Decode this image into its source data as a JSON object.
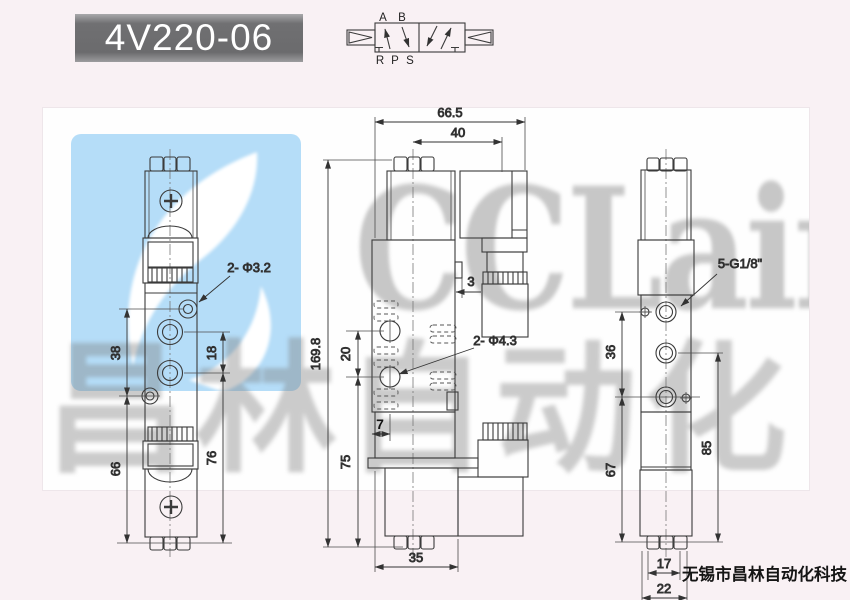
{
  "title": {
    "text": "4V220-06"
  },
  "schematic": {
    "labels_top": [
      "A",
      "B"
    ],
    "labels_bottom": [
      "R",
      "P",
      "S"
    ]
  },
  "watermarks": {
    "brand": "CCLair",
    "cn": "昌林自动化",
    "logo_color": "#b5ddf8"
  },
  "footer": {
    "company": "无锡市昌林自动化科技"
  },
  "dims": {
    "left": {
      "hole_label": "2- Φ3.2",
      "v38": "38",
      "v18": "18",
      "v66": "66",
      "v76": "76"
    },
    "front": {
      "w665": "66.5",
      "w40": "40",
      "h1698": "169.8",
      "v20": "20",
      "v3": "3",
      "v7": "7",
      "v75": "75",
      "v35": "35",
      "hole_label": "2- Φ4.3"
    },
    "right": {
      "port_label": "5-G1/8\"",
      "v36": "36",
      "v67": "67",
      "v85": "85",
      "v17": "17",
      "v22": "22"
    }
  },
  "colors": {
    "page_bg": "#f9f1f4",
    "title_bg": "#6e6e70",
    "line": "#3b3b3b"
  }
}
